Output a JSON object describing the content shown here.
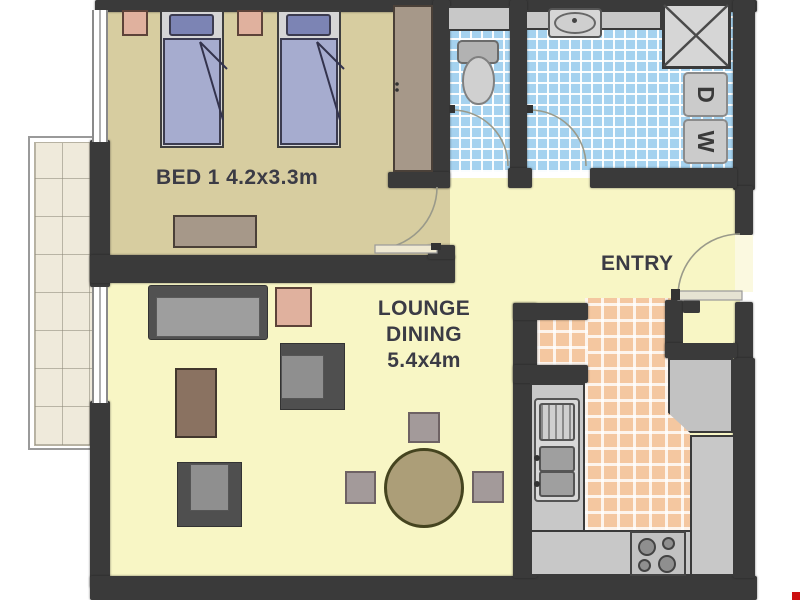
{
  "plan_type": "apartment floor plan",
  "labels": {
    "bed1": "BED 1 4.2x3.3m",
    "lounge1": "LOUNGE",
    "lounge2": "DINING",
    "lounge3": "5.4x4m",
    "entry": "ENTRY"
  },
  "appliances": {
    "dryer": "D",
    "washer": "W"
  },
  "rooms": [
    {
      "id": "bedroom-1",
      "label": "BED 1",
      "dimensions": "4.2x3.3m"
    },
    {
      "id": "lounge-dining",
      "label": "LOUNGE DINING",
      "dimensions": "5.4x4m"
    },
    {
      "id": "entry",
      "label": "ENTRY"
    }
  ],
  "colors": {
    "wall": "#3a3a3a",
    "bedroom_floor": "#d7cda0",
    "living_floor": "#f8f6c5",
    "bathroom_tile": "#a5d2ef",
    "kitchen_tile": "#f4c7a0",
    "balcony_floor": "#efeadb",
    "corner_marker": "#cc1111"
  }
}
